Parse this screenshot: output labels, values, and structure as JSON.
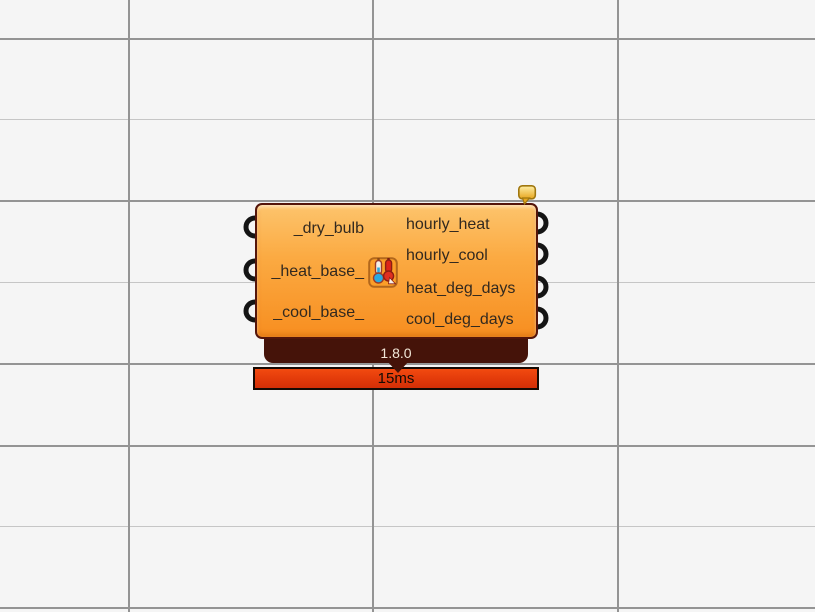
{
  "canvas": {
    "name": "grasshopper-canvas",
    "background_color": "#f5f5f5",
    "grid_major_color": "#949494",
    "grid_minor_color": "#c6c6c6"
  },
  "component": {
    "kind": "node-component",
    "icon": "thermometers-icon",
    "inputs": [
      {
        "label": "_dry_bulb"
      },
      {
        "label": "_heat_base_"
      },
      {
        "label": "_cool_base_"
      }
    ],
    "outputs": [
      {
        "label": "hourly_heat"
      },
      {
        "label": "hourly_cool"
      },
      {
        "label": "heat_deg_days"
      },
      {
        "label": "cool_deg_days"
      }
    ],
    "version": "1.8.0",
    "runtime": "15ms",
    "colors": {
      "body_top": "#fdc46c",
      "body_bottom": "#f78e20",
      "body_border": "#54150a",
      "version_badge": "#451309",
      "version_text": "#f3e8d9",
      "runtime_fill": "#e23a0a",
      "runtime_border": "#160a04",
      "balloon_fill": "#f2b92e",
      "port": "#141414"
    }
  }
}
